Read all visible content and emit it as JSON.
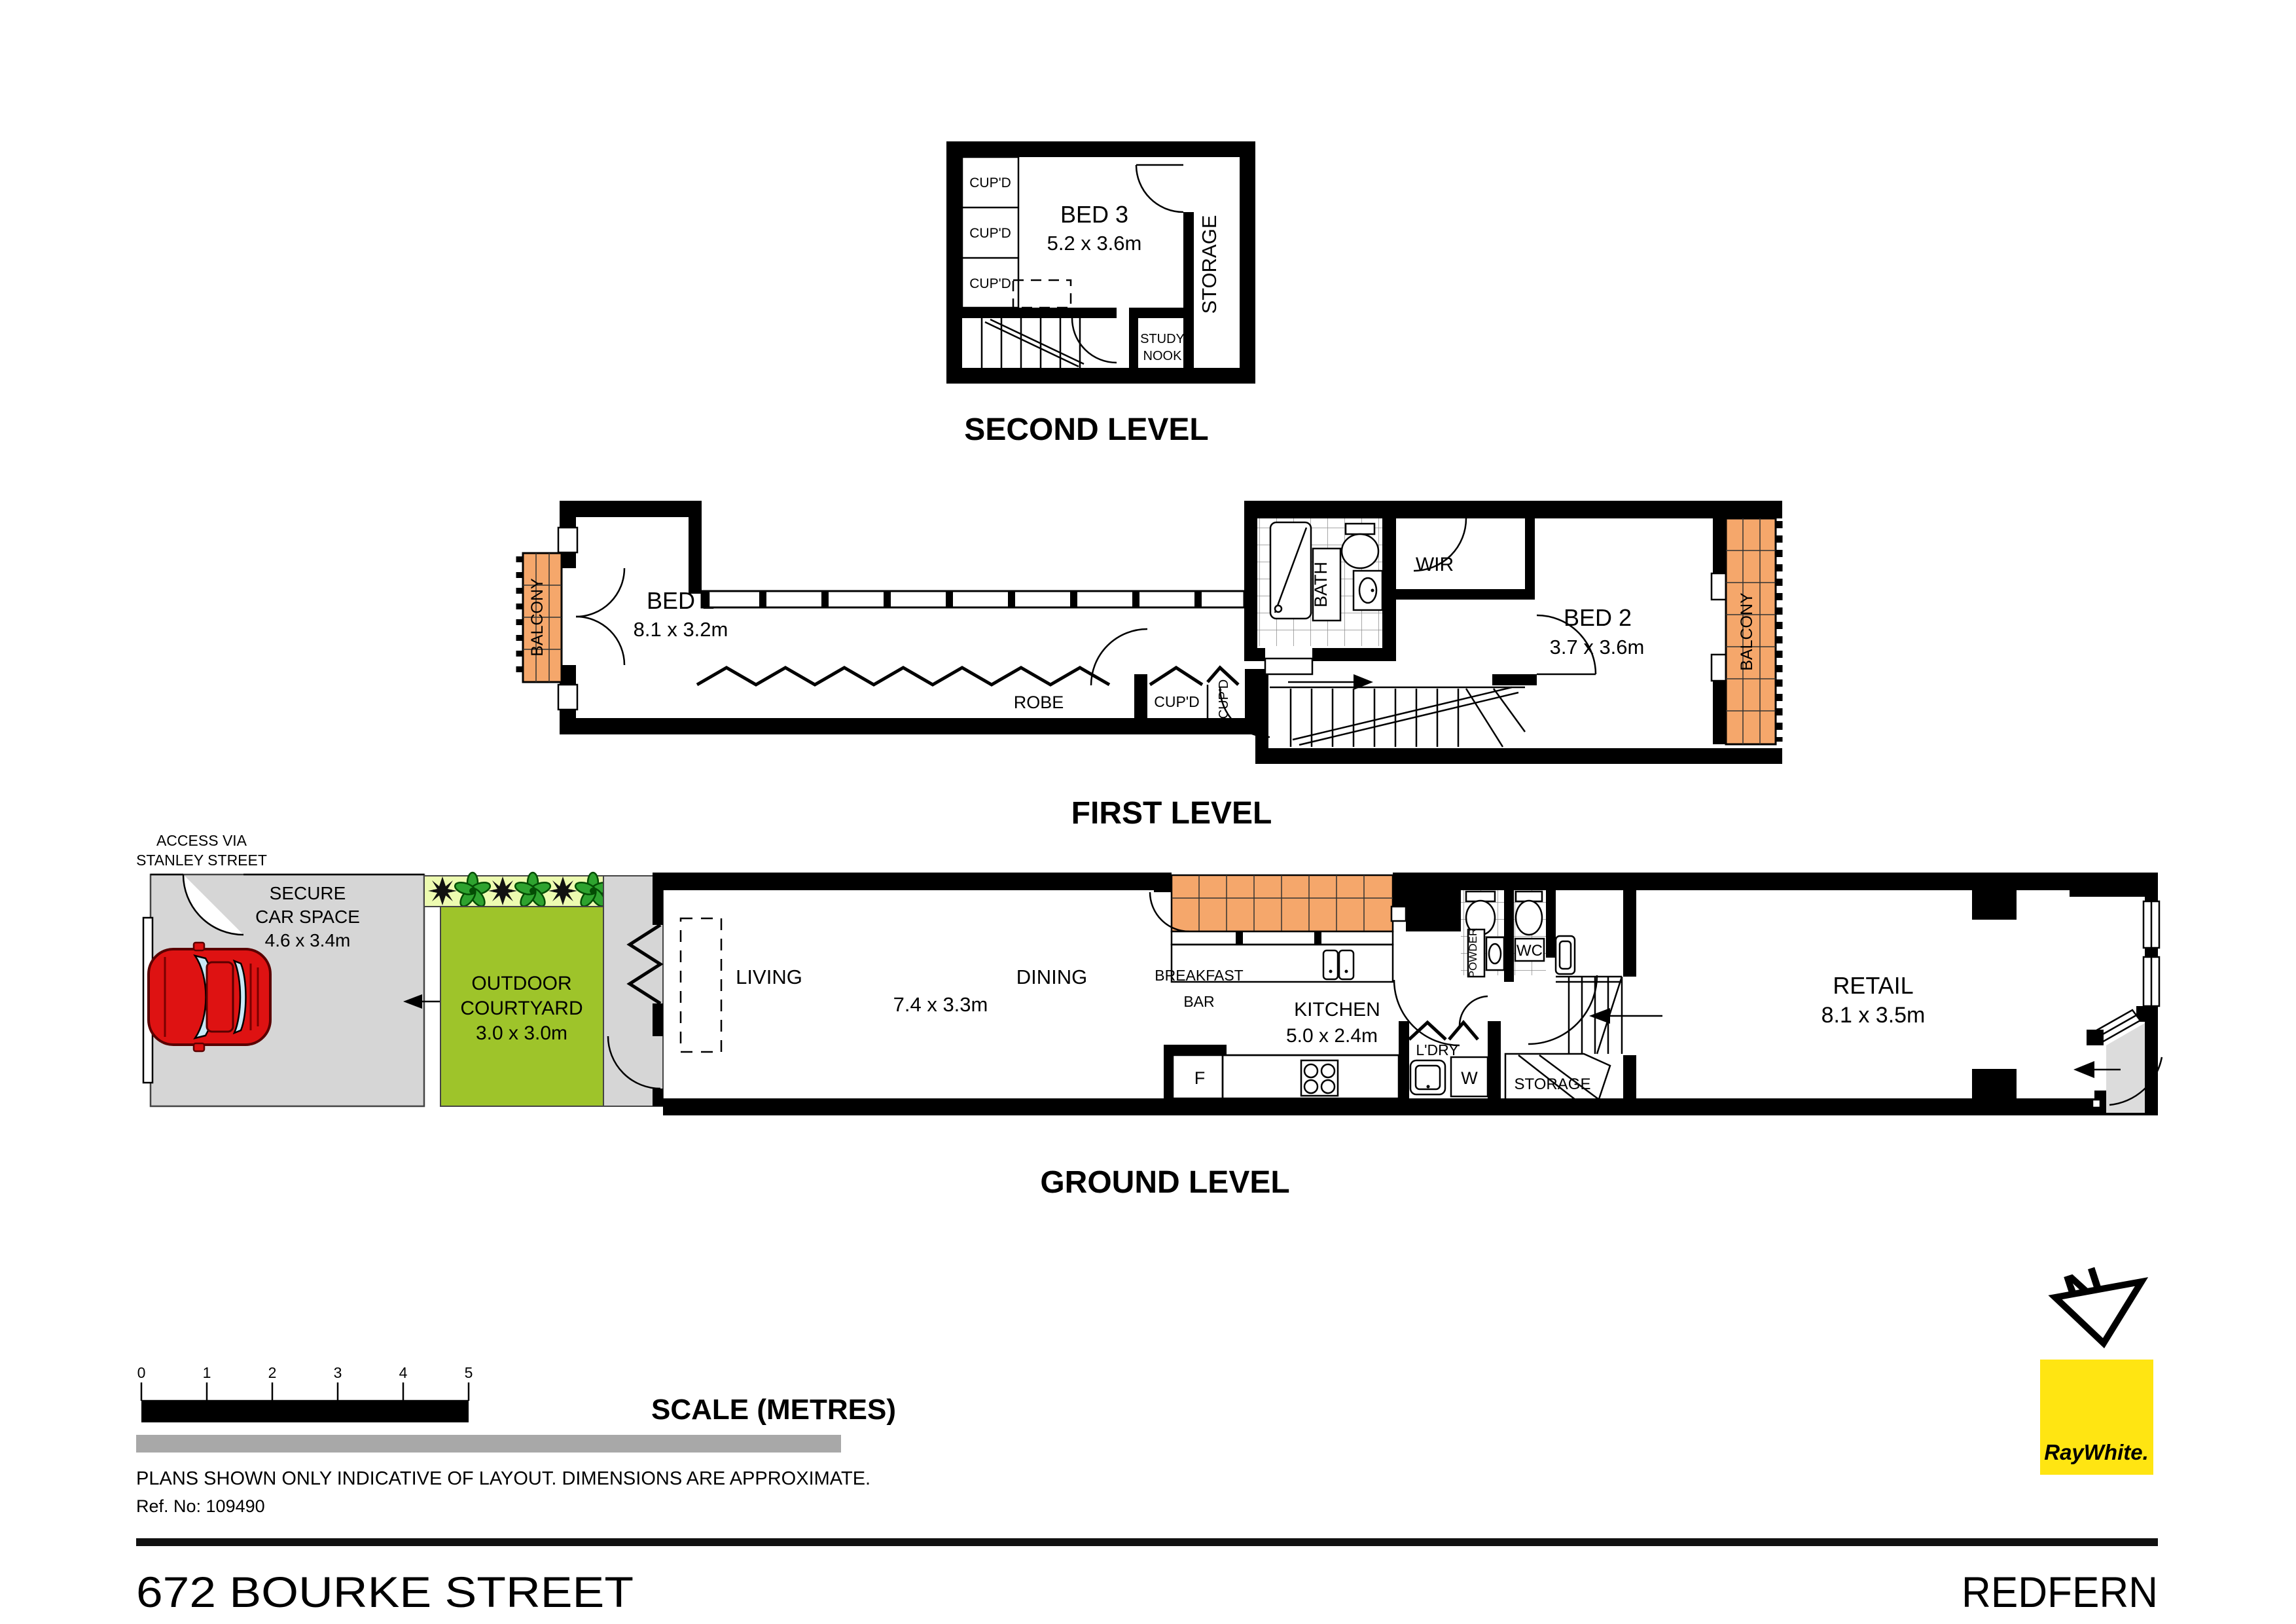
{
  "meta": {
    "address": "672 BOURKE STREET",
    "suburb": "REDFERN",
    "brand": "RayWhite."
  },
  "compass": {
    "north_label": "N"
  },
  "second_level": {
    "title": "SECOND LEVEL",
    "bed3_name": "BED 3",
    "bed3_dims": "5.2 x 3.6m",
    "cupboards": [
      "CUP'D",
      "CUP'D",
      "CUP'D"
    ],
    "storage": "STORAGE",
    "study_nook_line1": "STUDY",
    "study_nook_line2": "NOOK"
  },
  "first_level": {
    "title": "FIRST LEVEL",
    "bed1_name": "BED 1",
    "bed1_dims": "8.1 x 3.2m",
    "bed2_name": "BED 2",
    "bed2_dims": "3.7 x 3.6m",
    "balcony_left": "BALCONY",
    "balcony_right": "BALCONY",
    "bath": "BATH",
    "wir": "WIR",
    "robe": "ROBE",
    "cupboard1": "CUP'D",
    "cupboard2": "CUP'D"
  },
  "ground_level": {
    "title": "GROUND LEVEL",
    "access_line1": "ACCESS VIA",
    "access_line2": "STANLEY STREET",
    "car_space_line1": "SECURE",
    "car_space_line2": "CAR SPACE",
    "car_space_dims": "4.6 x 3.4m",
    "courtyard_line1": "OUTDOOR",
    "courtyard_line2": "COURTYARD",
    "courtyard_dims": "3.0 x 3.0m",
    "living": "LIVING",
    "dining": "DINING",
    "living_dining_dims": "7.4 x 3.3m",
    "breakfast_line1": "BREAKFAST",
    "breakfast_line2": "BAR",
    "kitchen_name": "KITCHEN",
    "kitchen_dims": "5.0 x 2.4m",
    "fridge": "F",
    "laundry": "L'DRY",
    "washer": "W",
    "powder": "POWDER",
    "wc": "WC",
    "storage": "STORAGE",
    "retail_name": "RETAIL",
    "retail_dims": "8.1 x 3.5m"
  },
  "footer": {
    "scale_ticks": [
      "0",
      "1",
      "2",
      "3",
      "4",
      "5"
    ],
    "scale_label": "SCALE (METRES)",
    "disclaimer": "PLANS SHOWN ONLY INDICATIVE OF LAYOUT.  DIMENSIONS ARE APPROXIMATE.",
    "ref": "Ref. No: 109490"
  },
  "colors": {
    "balcony_orange": "#F5A76B",
    "courtyard_green": "#9EC42A",
    "plant_strip": "#EDFBB0",
    "car_space_gray": "#D6D6D6",
    "car_red": "#DE1212",
    "ray_white_yellow": "#FFE512"
  }
}
